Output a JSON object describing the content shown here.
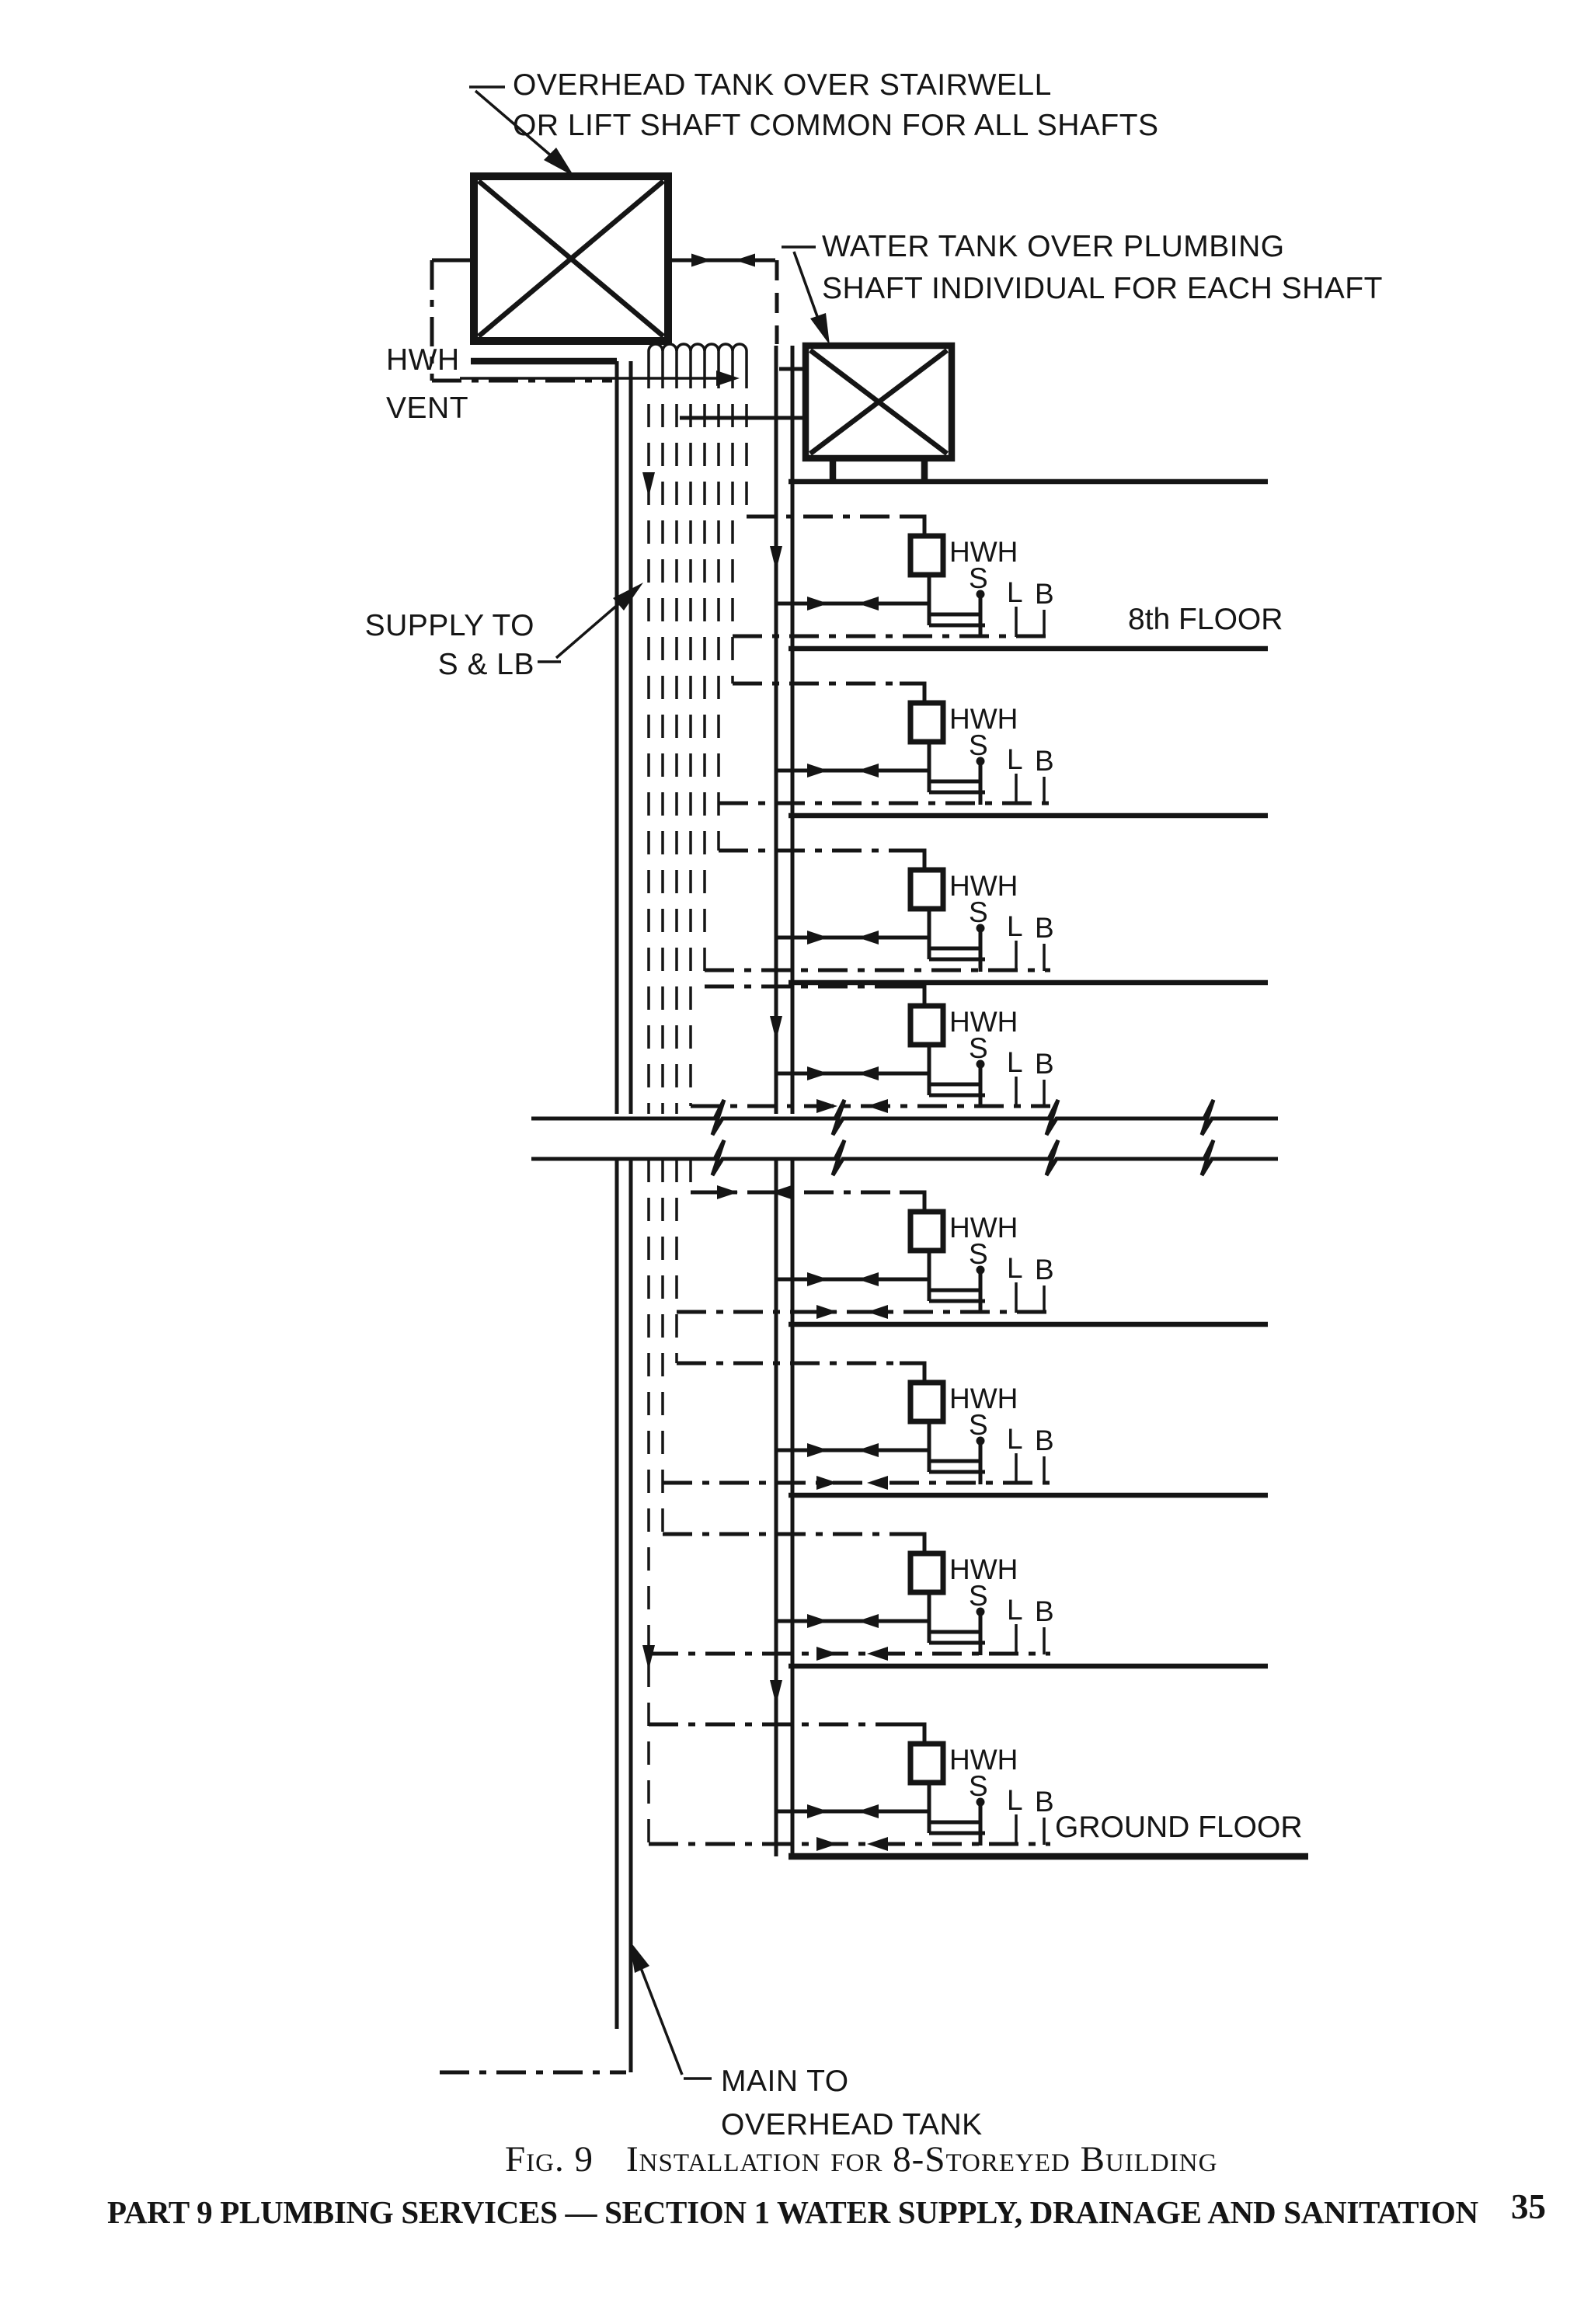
{
  "page": {
    "background": "#ffffff",
    "ink": "#151515"
  },
  "labels": {
    "overhead_tank_line1": "OVERHEAD TANK OVER STAIRWELL",
    "overhead_tank_line2": "OR LIFT SHAFT COMMON FOR ALL SHAFTS",
    "water_tank_line1": "WATER TANK OVER PLUMBING",
    "water_tank_line2": "SHAFT INDIVIDUAL FOR EACH SHAFT",
    "hwh_vent_line1": "HWH",
    "hwh_vent_line2": "VENT",
    "supply_line1": "SUPPLY TO",
    "supply_line2": "S & LB",
    "main_line1": "MAIN TO",
    "main_line2": "OVERHEAD TANK"
  },
  "unit_labels": {
    "heater": "HWH",
    "sink": "S",
    "lavatory": "L",
    "bath": "B"
  },
  "floors": [
    {
      "name": "8th-floor",
      "label": "8th FLOOR"
    },
    {
      "name": "7th-floor",
      "label": ""
    },
    {
      "name": "6th-floor",
      "label": ""
    },
    {
      "name": "5th-floor-break",
      "label": ""
    },
    {
      "name": "3rd-floor",
      "label": ""
    },
    {
      "name": "2nd-floor",
      "label": ""
    },
    {
      "name": "1st-floor",
      "label": ""
    },
    {
      "name": "ground-floor",
      "label": "GROUND FLOOR"
    }
  ],
  "caption": {
    "fig_label": "Fig. 9",
    "title": "Installation for 8-Storeyed Building"
  },
  "footer": {
    "left": "PART 9 PLUMBING SERVICES — SECTION 1 WATER SUPPLY, DRAINAGE AND SANITATION",
    "page": "35"
  }
}
